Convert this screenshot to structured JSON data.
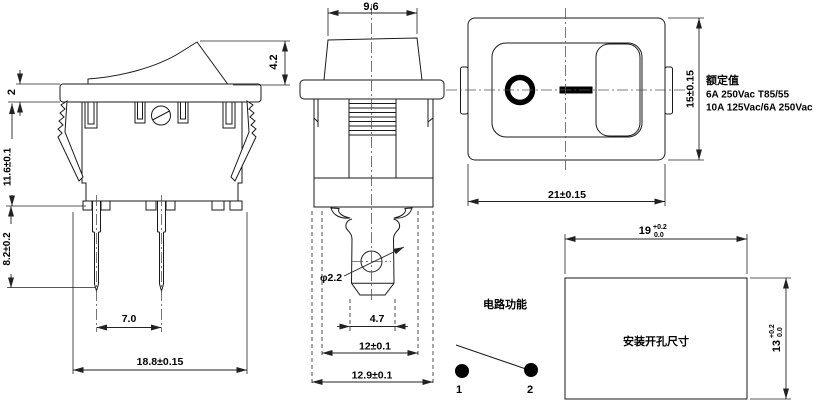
{
  "side_view": {
    "dim_rocker_height": "4.2",
    "dim_flange_thickness": "2",
    "dim_body_height": "11.6±0.1",
    "dim_pin_length": "8.2±0.2",
    "dim_pin_spacing": "7.0",
    "dim_body_width": "18.8±0.15"
  },
  "front_view": {
    "dim_cap_width": "9.6",
    "dim_hole_diameter": "φ2.2",
    "dim_terminal_width": "4.7",
    "dim_body_width": "12±0.1",
    "dim_flange_width": "12.9±0.1"
  },
  "top_view": {
    "dim_height": "15±0.15",
    "dim_width": "21±0.15",
    "symbol_off": "O",
    "symbol_on": "—"
  },
  "rating": {
    "title": "额定值",
    "line1": "6A 250Vac T85/55",
    "line2": "10A 125Vac/6A 250Vac"
  },
  "circuit": {
    "title": "电路功能",
    "terminal_1": "1",
    "terminal_2": "2"
  },
  "mounting": {
    "label": "安装开孔尺寸",
    "width_value": "19",
    "width_tol_upper": "+0.2",
    "width_tol_lower": "0.0",
    "height_value": "13",
    "height_tol_upper": "+0.2",
    "height_tol_lower": "0.0"
  },
  "colors": {
    "line": "#1a1a1a",
    "text": "#000000",
    "background": "#ffffff"
  }
}
